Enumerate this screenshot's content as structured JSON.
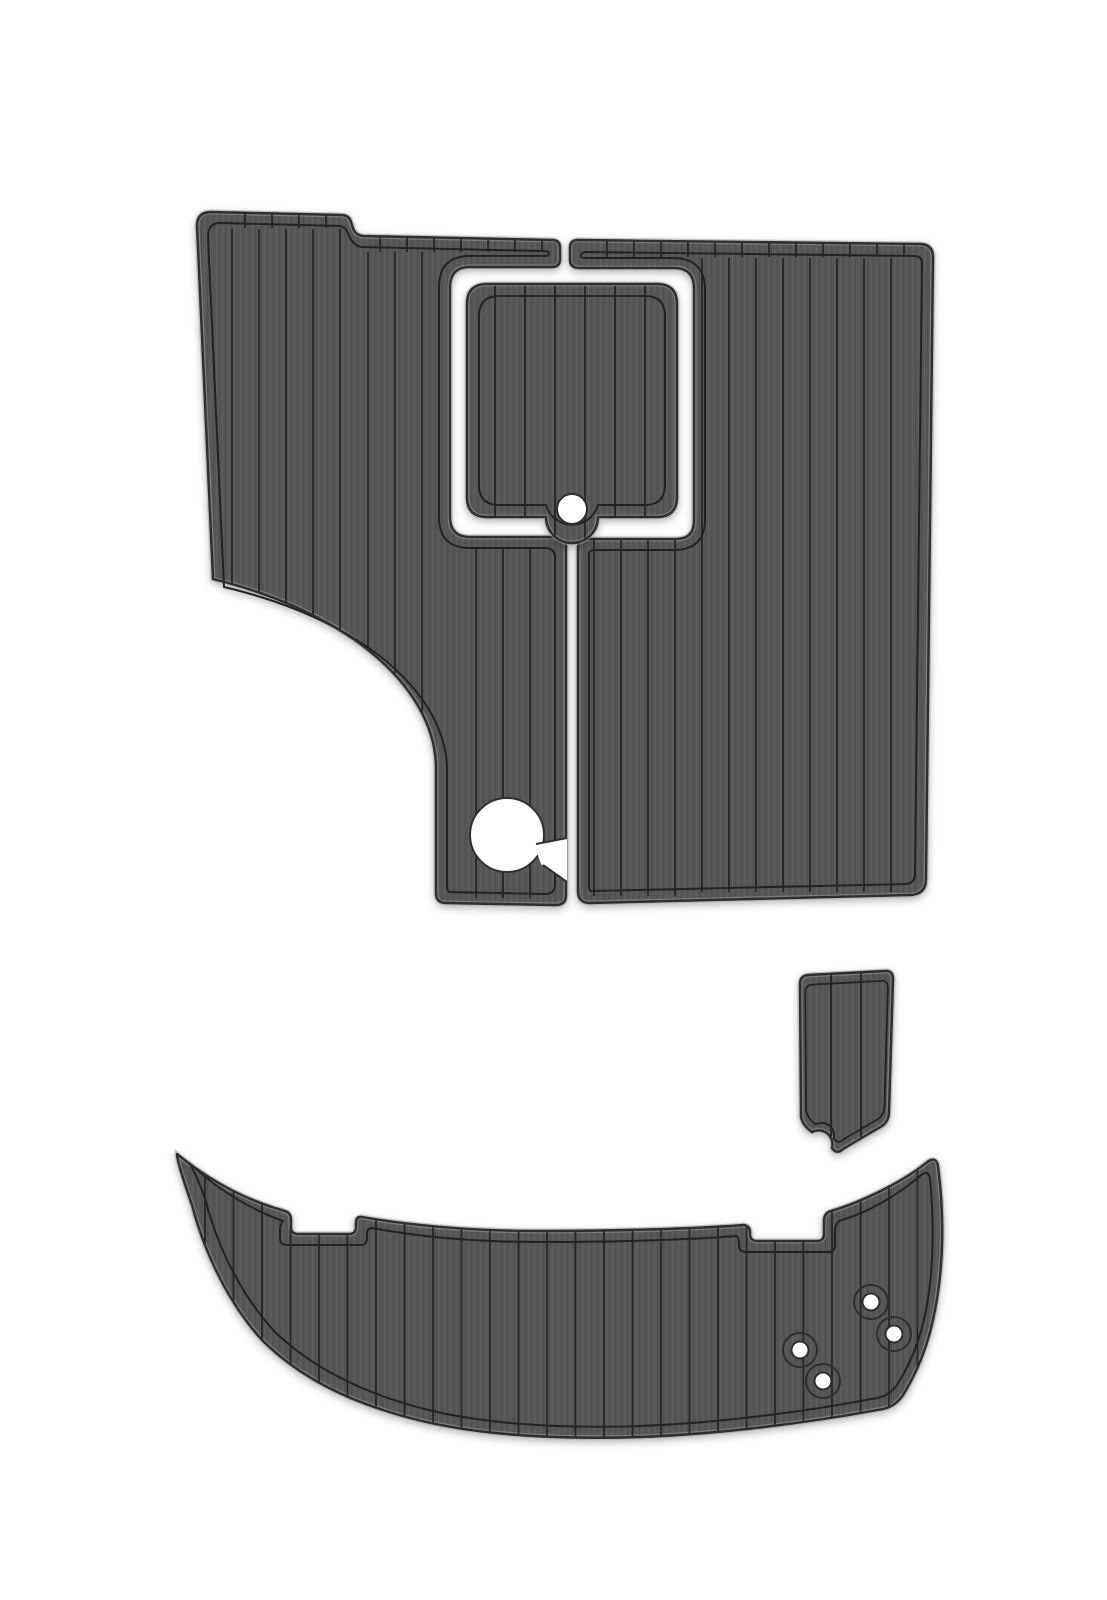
{
  "scene": {
    "kind": "product-photo",
    "subject": "EVA foam faux-teak boat decking pad set",
    "background": "#ffffff",
    "width": 1107,
    "height": 1600
  },
  "colors": {
    "pad_base": "#575757",
    "stripe_light": "#5d5d5d",
    "stripe_dark": "#515151",
    "plank_line": "#262626",
    "border_line": "#232323",
    "outer_line": "#2e2e2e",
    "rim_highlight": "#999999",
    "hole_fill": "#ffffff",
    "shadow": "rgba(0,0,0,0.28)"
  },
  "pieces": [
    {
      "id": "cockpit-pad-left",
      "label": "port cockpit pad with corner scoop and cup cutout",
      "outer": "M 197 226 Q 197 212 211 212 L 341 215 Q 349 215 351 222 L 353 228 Q 355 235 363 236 L 552 240 Q 560 240 560 248 L 560 259 Q 560 267 552 267 L 470 267 Q 450 267 450 287 L 450 517 Q 450 537 470 537 L 556 537 Q 566 537 566 547 L 566 895 Q 566 905 556 905 L 446 903 Q 436 903 436 893 L 436 768 C 436 696 362 616 213 579 Z",
      "borders": [
        {
          "d": "M 208 237 Q 208 223 220 223 L 340 226 Q 346 227 348 233 Q 352 245 361 247 L 541 251 Q 549 251 549 253 Q 549 256 544 256 L 470 256 Q 439 256 439 287 L 439 517 Q 439 548 470 548 L 545 548 Q 555 548 555 558 L 555 884 Q 555 894 545 894 L 449 892 Q 447 892 447 882 L 447 770 C 447 700 372 622 224 587 Z"
        }
      ],
      "planks": [
        {
          "x0": 232,
          "x1": 341,
          "step": 27,
          "y0": 229,
          "y1": 900
        },
        {
          "x0": 368,
          "x1": 422,
          "step": 27,
          "y0": 252,
          "y1": 900
        },
        {
          "x0": 476,
          "x1": 530,
          "step": 27,
          "y0": 549,
          "y1": 898
        }
      ],
      "ticks": [
        {
          "x0": 245,
          "x1": 326,
          "step": 27,
          "y0": 210,
          "y1": 228
        },
        {
          "x0": 380,
          "x1": 542,
          "step": 27,
          "y0": 235,
          "y1": 252
        }
      ],
      "overlays": [
        {
          "type": "circle",
          "name": "cup-hole",
          "cx": 507,
          "cy": 835,
          "r": 37,
          "fill": "#ffffff",
          "stroke": true
        },
        {
          "type": "path",
          "name": "cup-hole-notch",
          "d": "M 534 844 L 567 838 L 567 882 L 541 864 Z",
          "fill": "#ffffff"
        },
        {
          "type": "path",
          "name": "cup-hole-notch-edge",
          "d": "M 536 844 L 567 838 M 543 865 L 567 882",
          "fill": "none",
          "stroke": true
        }
      ]
    },
    {
      "id": "cockpit-pad-right",
      "label": "starboard cockpit pad wrapping hatch channel",
      "outer": "M 570 248 Q 570 240 578 240 L 921 244 Q 933 245 933 257 L 926 879 Q 926 894 911 895 L 590 903 Q 578 903 578 891 L 578 549 Q 578 539 588 539 L 676 539 Q 694 539 694 521 L 694 288 Q 694 268 674 268 L 580 268 Q 570 268 570 260 Z",
      "borders": [
        {
          "d": "M 581 256 Q 581 252 586 252 L 916 256 Q 922 257 922 263 L 915 874 Q 915 883 906 884 L 592 891 Q 589 891 589 886 L 589 554 Q 589 550 594 550 L 674 550 Q 705 550 705 519 L 705 290 Q 705 258 673 258 L 586 258 Q 581 258 581 256 Z"
        }
      ],
      "planks": [
        {
          "x0": 594,
          "x1": 675,
          "step": 27,
          "y0": 540,
          "y1": 896
        },
        {
          "x0": 702,
          "x1": 891,
          "step": 27,
          "y0": 258,
          "y1": 892
        }
      ],
      "ticks": [
        {
          "x0": 607,
          "x1": 904,
          "step": 27,
          "y0": 241,
          "y1": 257
        }
      ],
      "overlays": []
    },
    {
      "id": "center-hatch-pad",
      "label": "hatch insert pad with finger-pull hole",
      "outer": "M 467 304 Q 467 284 487 284 L 657 284 Q 677 284 677 304 L 677 497 Q 677 517 657 517 L 598 517 A 26 26 0 0 1 546 517 L 487 517 Q 467 517 467 497 Z",
      "borders": [
        {
          "d": "M 479 316 Q 479 296 499 296 L 645 296 Q 665 296 665 316 L 665 485 Q 665 505 645 505 L 598 505 A 27 27 0 0 1 546 505 L 499 505 Q 479 505 479 485 Z"
        }
      ],
      "planks": [
        {
          "x0": 495,
          "x1": 645,
          "step": 30,
          "y0": 286,
          "y1": 540
        }
      ],
      "ticks": [],
      "overlays": [
        {
          "type": "circle",
          "name": "finger-pull-hole",
          "cx": 572,
          "cy": 509,
          "r": 15,
          "fill": "#ffffff",
          "stroke": true
        }
      ]
    },
    {
      "id": "transom-wedge-pad",
      "label": "small shield-shaped transom step pad",
      "outer": "M 800 984 Q 800 976 808 975 L 885 971 Q 893 970 893 979 L 889 1112 Q 889 1121 882 1126 L 843 1149 Q 837 1155 832 1148 A 14 14 0 0 0 812 1132 Q 803 1126 801 1117 Z",
      "borders": [
        {
          "d": "M 800 984 Q 800 976 808 975 L 885 971 Q 893 970 893 979 L 889 1112 Q 889 1121 882 1126 L 843 1149 Q 837 1155 832 1148 A 14 14 0 0 0 812 1132 Q 803 1126 801 1117 Z",
          "transform": "translate(93.2,116.8) scale(0.89)"
        }
      ],
      "planks": [
        {
          "x0": 831,
          "x1": 861,
          "step": 30,
          "y0": 962,
          "y1": 1162
        }
      ],
      "ticks": [],
      "overlays": []
    },
    {
      "id": "swim-platform-pad",
      "label": "curved swim platform pad with bolt holes",
      "outer": "M 177 1154 C 215 1185 252 1202 285 1211 Q 291 1213 291 1220 L 291 1227 Q 291 1234 298 1234 L 349 1234 Q 356 1234 356 1227 L 356 1223 Q 356 1216 362 1217 C 420 1227 480 1231 540 1231 C 610 1231 690 1229 744 1225 Q 750 1226 750 1232 L 750 1234 Q 750 1241 757 1241 L 817 1241 Q 824 1241 824 1234 L 824 1221 Q 824 1213 831 1211 C 865 1201 905 1180 926 1163 Q 936 1155 938 1166 C 943 1205 944 1245 939 1285 C 933 1332 922 1363 905 1392 Q 897 1406 883 1409 C 808 1423 720 1434 640 1437 C 550 1440 470 1434 410 1418 C 350 1402 300 1378 262 1340 C 230 1305 205 1255 192 1205 Q 177 1162 177 1154 Z",
      "borders": [
        {
          "d": "M 189 1163 C 222 1193 255 1211 283 1221 Q 280 1224 280 1230 L 280 1238 Q 280 1245 287 1245 L 360 1245 Q 367 1245 367 1238 L 367 1234 Q 367 1228 372 1228 C 425 1238 480 1242 540 1242 C 608 1242 682 1240 737 1236 Q 739 1239 739 1244 L 739 1245 Q 739 1252 746 1252 L 828 1252 Q 835 1252 835 1245 L 835 1231 Q 835 1222 842 1220 C 872 1211 903 1191 920 1176 Q 928 1169 930 1178 C 933 1212 934 1247 930 1284 C 925 1328 914 1358 897 1385 Q 889 1396 877 1398 C 804 1412 718 1423 640 1426 C 553 1429 475 1423 417 1407 C 359 1391 311 1367 274 1331 C 243 1297 219 1251 206 1202 Q 196 1172 189 1163 Z"
        }
      ],
      "planks": [
        {
          "x0": 205,
          "x1": 930,
          "step": 28.5,
          "y0": 1135,
          "y1": 1448
        }
      ],
      "ticks": [],
      "overlays": [
        {
          "type": "circle",
          "name": "bolt-ring-1",
          "cx": 871,
          "cy": 1302,
          "r": 17,
          "fill": "none",
          "stroke": true
        },
        {
          "type": "circle",
          "name": "bolt-ring-2",
          "cx": 894,
          "cy": 1334,
          "r": 17,
          "fill": "none",
          "stroke": true
        },
        {
          "type": "circle",
          "name": "bolt-ring-3",
          "cx": 800,
          "cy": 1350,
          "r": 17,
          "fill": "none",
          "stroke": true
        },
        {
          "type": "circle",
          "name": "bolt-ring-4",
          "cx": 823,
          "cy": 1381,
          "r": 17,
          "fill": "none",
          "stroke": true
        },
        {
          "type": "circle",
          "name": "bolt-hole-1",
          "cx": 871,
          "cy": 1302,
          "r": 8.5,
          "fill": "#ffffff",
          "stroke": true
        },
        {
          "type": "circle",
          "name": "bolt-hole-2",
          "cx": 894,
          "cy": 1334,
          "r": 8.5,
          "fill": "#ffffff",
          "stroke": true
        },
        {
          "type": "circle",
          "name": "bolt-hole-3",
          "cx": 800,
          "cy": 1350,
          "r": 8.5,
          "fill": "#ffffff",
          "stroke": true
        },
        {
          "type": "circle",
          "name": "bolt-hole-4",
          "cx": 823,
          "cy": 1381,
          "r": 8.5,
          "fill": "#ffffff",
          "stroke": true
        }
      ]
    }
  ],
  "line_widths": {
    "plank": 1.8,
    "border": 2,
    "outer": 2.4,
    "rim": 5
  }
}
